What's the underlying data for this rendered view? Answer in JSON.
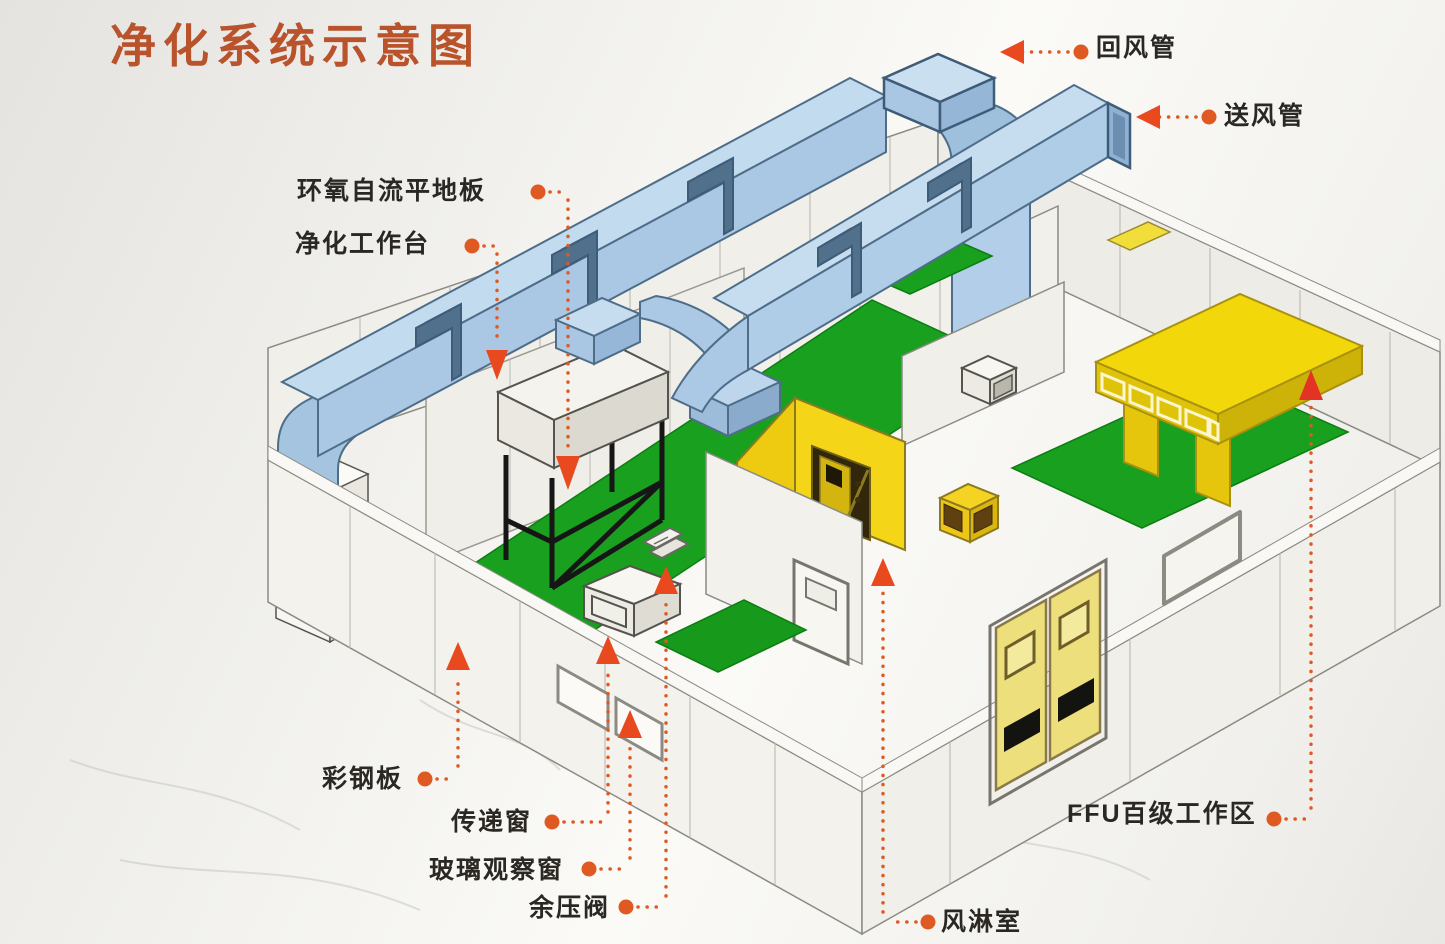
{
  "title": "净化系统示意图",
  "labels": {
    "return_duct": "回风管",
    "supply_duct": "送风管",
    "epoxy_floor": "环氧自流平地板",
    "clean_workbench": "净化工作台",
    "color_steel_panel": "彩钢板",
    "transfer_window": "传递窗",
    "glass_observation_window": "玻璃观察窗",
    "residual_pressure_valve": "余压阀",
    "air_shower": "风淋室",
    "ffu_work_area": "FFU百级工作区"
  },
  "colors": {
    "leader_accent": "#df5a22",
    "arrow": "#e8491f",
    "title_text": "#b8532c",
    "label_text": "#2b2824",
    "duct_blue": "#b0cde8",
    "floor_green": "#18a01e",
    "highlight_yellow": "#f2d70b",
    "panel_white": "#f3f1eb"
  }
}
